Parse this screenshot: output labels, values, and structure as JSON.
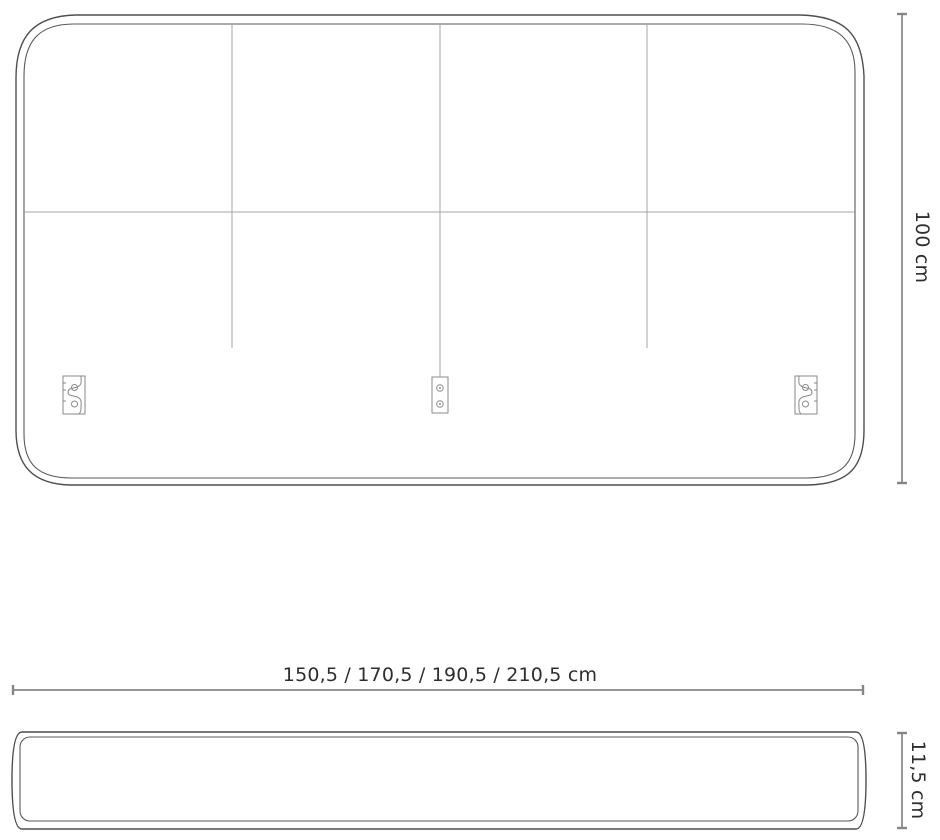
{
  "diagram": {
    "title": "headboard-dimension-drawing",
    "front_view": {
      "panel_grid": {
        "columns": 4,
        "rows": 2
      },
      "height_dimension": {
        "label": "100 cm"
      },
      "width_dimension": {
        "label": "150,5 / 170,5 / 190,5 / 210,5 cm"
      },
      "brackets": [
        {
          "name": "keyhole-bracket-left"
        },
        {
          "name": "screw-plate-bracket-center"
        },
        {
          "name": "keyhole-bracket-right"
        }
      ]
    },
    "side_view": {
      "thickness_dimension": {
        "label": "11,5 cm"
      }
    },
    "colors": {
      "background": "#ffffff",
      "outline": "#4f4f4f",
      "inner_line": "#5a5a5a",
      "seam": "#a5a5a5",
      "bracket": "#8a8a8a",
      "dimension": "#868686",
      "text": "#2e2e2e"
    }
  }
}
